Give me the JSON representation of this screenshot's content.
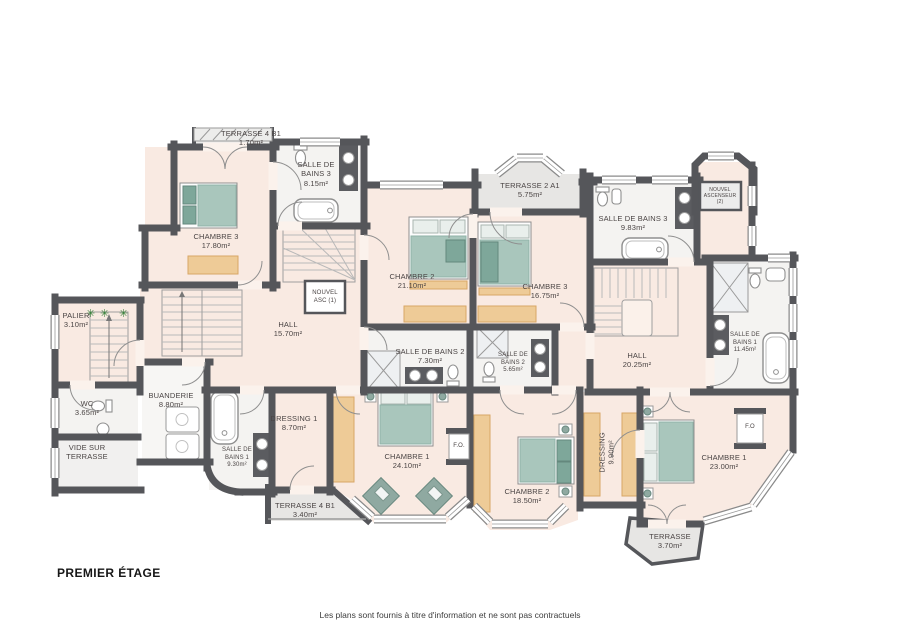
{
  "meta": {
    "title": "PREMIER ÉTAGE",
    "disclaimer": "Les plans sont fournis à titre d'information et ne sont pas contractuels"
  },
  "colors": {
    "wall": "#55565a",
    "room_pink": "#f9eae2",
    "bathroom": "#f4f3f1",
    "terrace": "#e7e6e4",
    "furniture_tan": "#eecb97",
    "bed_green": "#a9c6bc",
    "accent_green": "#7ea79a",
    "plant_green": "#2e7d32"
  },
  "icons": {
    "plant_glyph": "✳"
  },
  "labels": {
    "terrasse4b1_top": {
      "l1": "TERRASSE 4 B1",
      "l2": "1.70m²"
    },
    "sdb3_w": {
      "l1": "SALLE DE",
      "l2": "BAINS 3",
      "l3": "8.15m²"
    },
    "chambre3_w": {
      "l1": "CHAMBRE 3",
      "l2": "17.80m²"
    },
    "asc1": {
      "l1": "NOUVEL",
      "l2": "ASC (1)"
    },
    "terrasse2a1": {
      "l1": "TERRASSE 2 A1",
      "l2": "5.75m²"
    },
    "chambre2_t": {
      "l1": "CHAMBRE 2",
      "l2": "21.10m²"
    },
    "chambre3_e": {
      "l1": "CHAMBRE 3",
      "l2": "16.75m²"
    },
    "sdb3_e": {
      "l1": "SALLE DE BAINS 3",
      "l2": "9.83m²"
    },
    "asc2": {
      "l1": "NOUVEL",
      "l2": "ASCENSEUR",
      "l3": "(2)"
    },
    "palier": {
      "l1": "PALIER",
      "l2": "3.10m²"
    },
    "hall_w": {
      "l1": "HALL",
      "l2": "15.70m²"
    },
    "sdb2_w": {
      "l1": "SALLE DE BAINS 2",
      "l2": "7.30m²"
    },
    "sdb2_e": {
      "l1": "SALLE DE",
      "l2": "BAINS 2",
      "l3": "5.65m²"
    },
    "hall_e": {
      "l1": "HALL",
      "l2": "20.25m²"
    },
    "sdb1_e": {
      "l1": "SALLE DE",
      "l2": "BAINS 1",
      "l3": "11.45m²"
    },
    "wc": {
      "l1": "WC",
      "l2": "3.65m²"
    },
    "buanderie": {
      "l1": "BUANDERIE",
      "l2": "8.80m²"
    },
    "dressing1": {
      "l1": "DRESSING 1",
      "l2": "8.70m²"
    },
    "vide": {
      "l1": "VIDE SUR",
      "l2": "TERRASSE"
    },
    "sdb1_w": {
      "l1": "SALLE DE",
      "l2": "BAINS 1",
      "l3": "9.30m²"
    },
    "chambre1_sw": {
      "l1": "CHAMBRE 1",
      "l2": "24.10m²"
    },
    "fo_west": {
      "l1": "F.O."
    },
    "chambre2_s": {
      "l1": "CHAMBRE 2",
      "l2": "18.50m²"
    },
    "dressing_e": {
      "l1": "DRESSING",
      "l2": "9.90m²"
    },
    "chambre1_e": {
      "l1": "CHAMBRE 1",
      "l2": "23.00m²"
    },
    "fo_east": {
      "l1": "F.O"
    },
    "terrasse4b1_s": {
      "l1": "TERRASSE 4 B1",
      "l2": "3.40m²"
    },
    "terrasse_s": {
      "l1": "TERRASSE",
      "l2": "3.70m²"
    }
  }
}
